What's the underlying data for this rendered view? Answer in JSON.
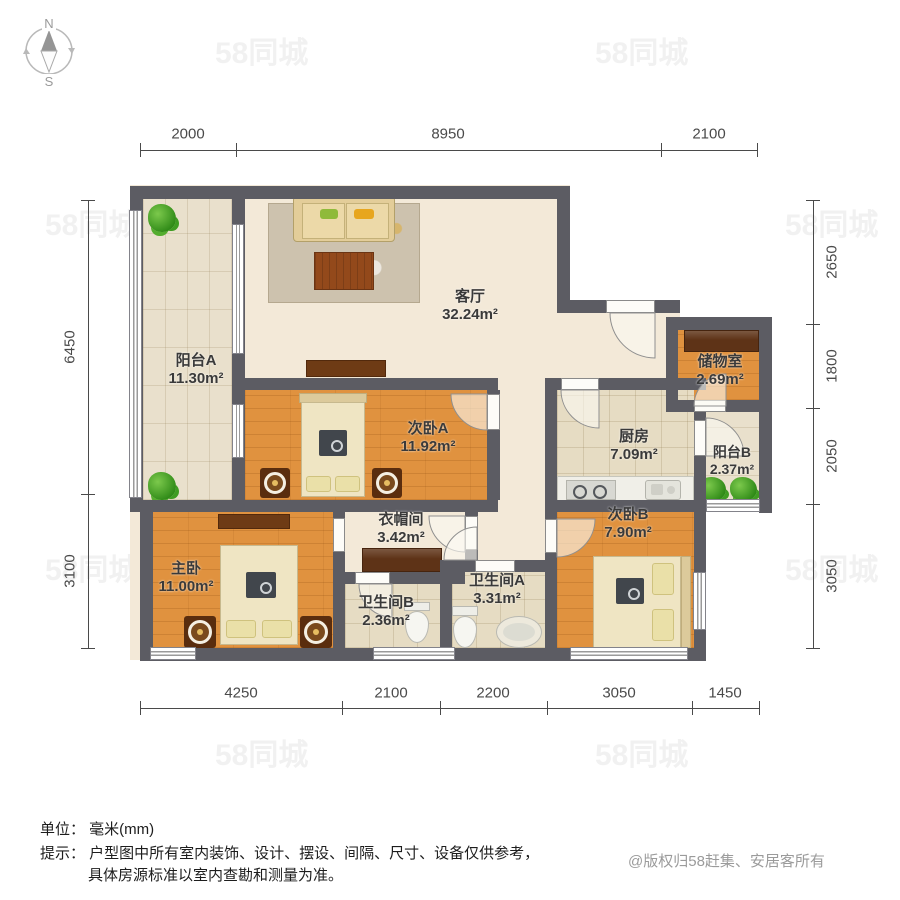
{
  "compass": {
    "north": "N",
    "south": "S"
  },
  "dimensions": {
    "unit": "mm",
    "top": [
      {
        "label": "2000"
      },
      {
        "label": "8950"
      },
      {
        "label": "2100"
      }
    ],
    "bottom": [
      {
        "label": "4250"
      },
      {
        "label": "2100"
      },
      {
        "label": "2200"
      },
      {
        "label": "3050"
      },
      {
        "label": "1450"
      }
    ],
    "left": [
      {
        "label": "6450"
      },
      {
        "label": "3100"
      }
    ],
    "right": [
      {
        "label": "2650"
      },
      {
        "label": "1800"
      },
      {
        "label": "2050"
      },
      {
        "label": "3050"
      }
    ]
  },
  "rooms": [
    {
      "name": "阳台A",
      "area": "11.30m²"
    },
    {
      "name": "客厅",
      "area": "32.24m²"
    },
    {
      "name": "储物室",
      "area": "2.69m²"
    },
    {
      "name": "次卧A",
      "area": "11.92m²"
    },
    {
      "name": "厨房",
      "area": "7.09m²"
    },
    {
      "name": "阳台B",
      "area": "2.37m²"
    },
    {
      "name": "衣帽间",
      "area": "3.42m²"
    },
    {
      "name": "次卧B",
      "area": "7.90m²"
    },
    {
      "name": "主卧",
      "area": "11.00m²"
    },
    {
      "name": "卫生间B",
      "area": "2.36m²"
    },
    {
      "name": "卫生间A",
      "area": "3.31m²"
    }
  ],
  "watermark": {
    "text": "58同城"
  },
  "footer": {
    "unit_line": "单位： 毫米(mm)",
    "tip_line1": "提示： 户型图中所有室内装饰、设计、摆设、间隔、尺寸、设备仅供参考，",
    "tip_line2": "具体房源标准以室内查勘和测量为准。",
    "copyright": "@版权归58赶集、安居客所有"
  },
  "colors": {
    "wall": "#5C5C63",
    "wood": "#E0923F",
    "living": "#F3E9D8",
    "cabinet": "#5E3317"
  }
}
